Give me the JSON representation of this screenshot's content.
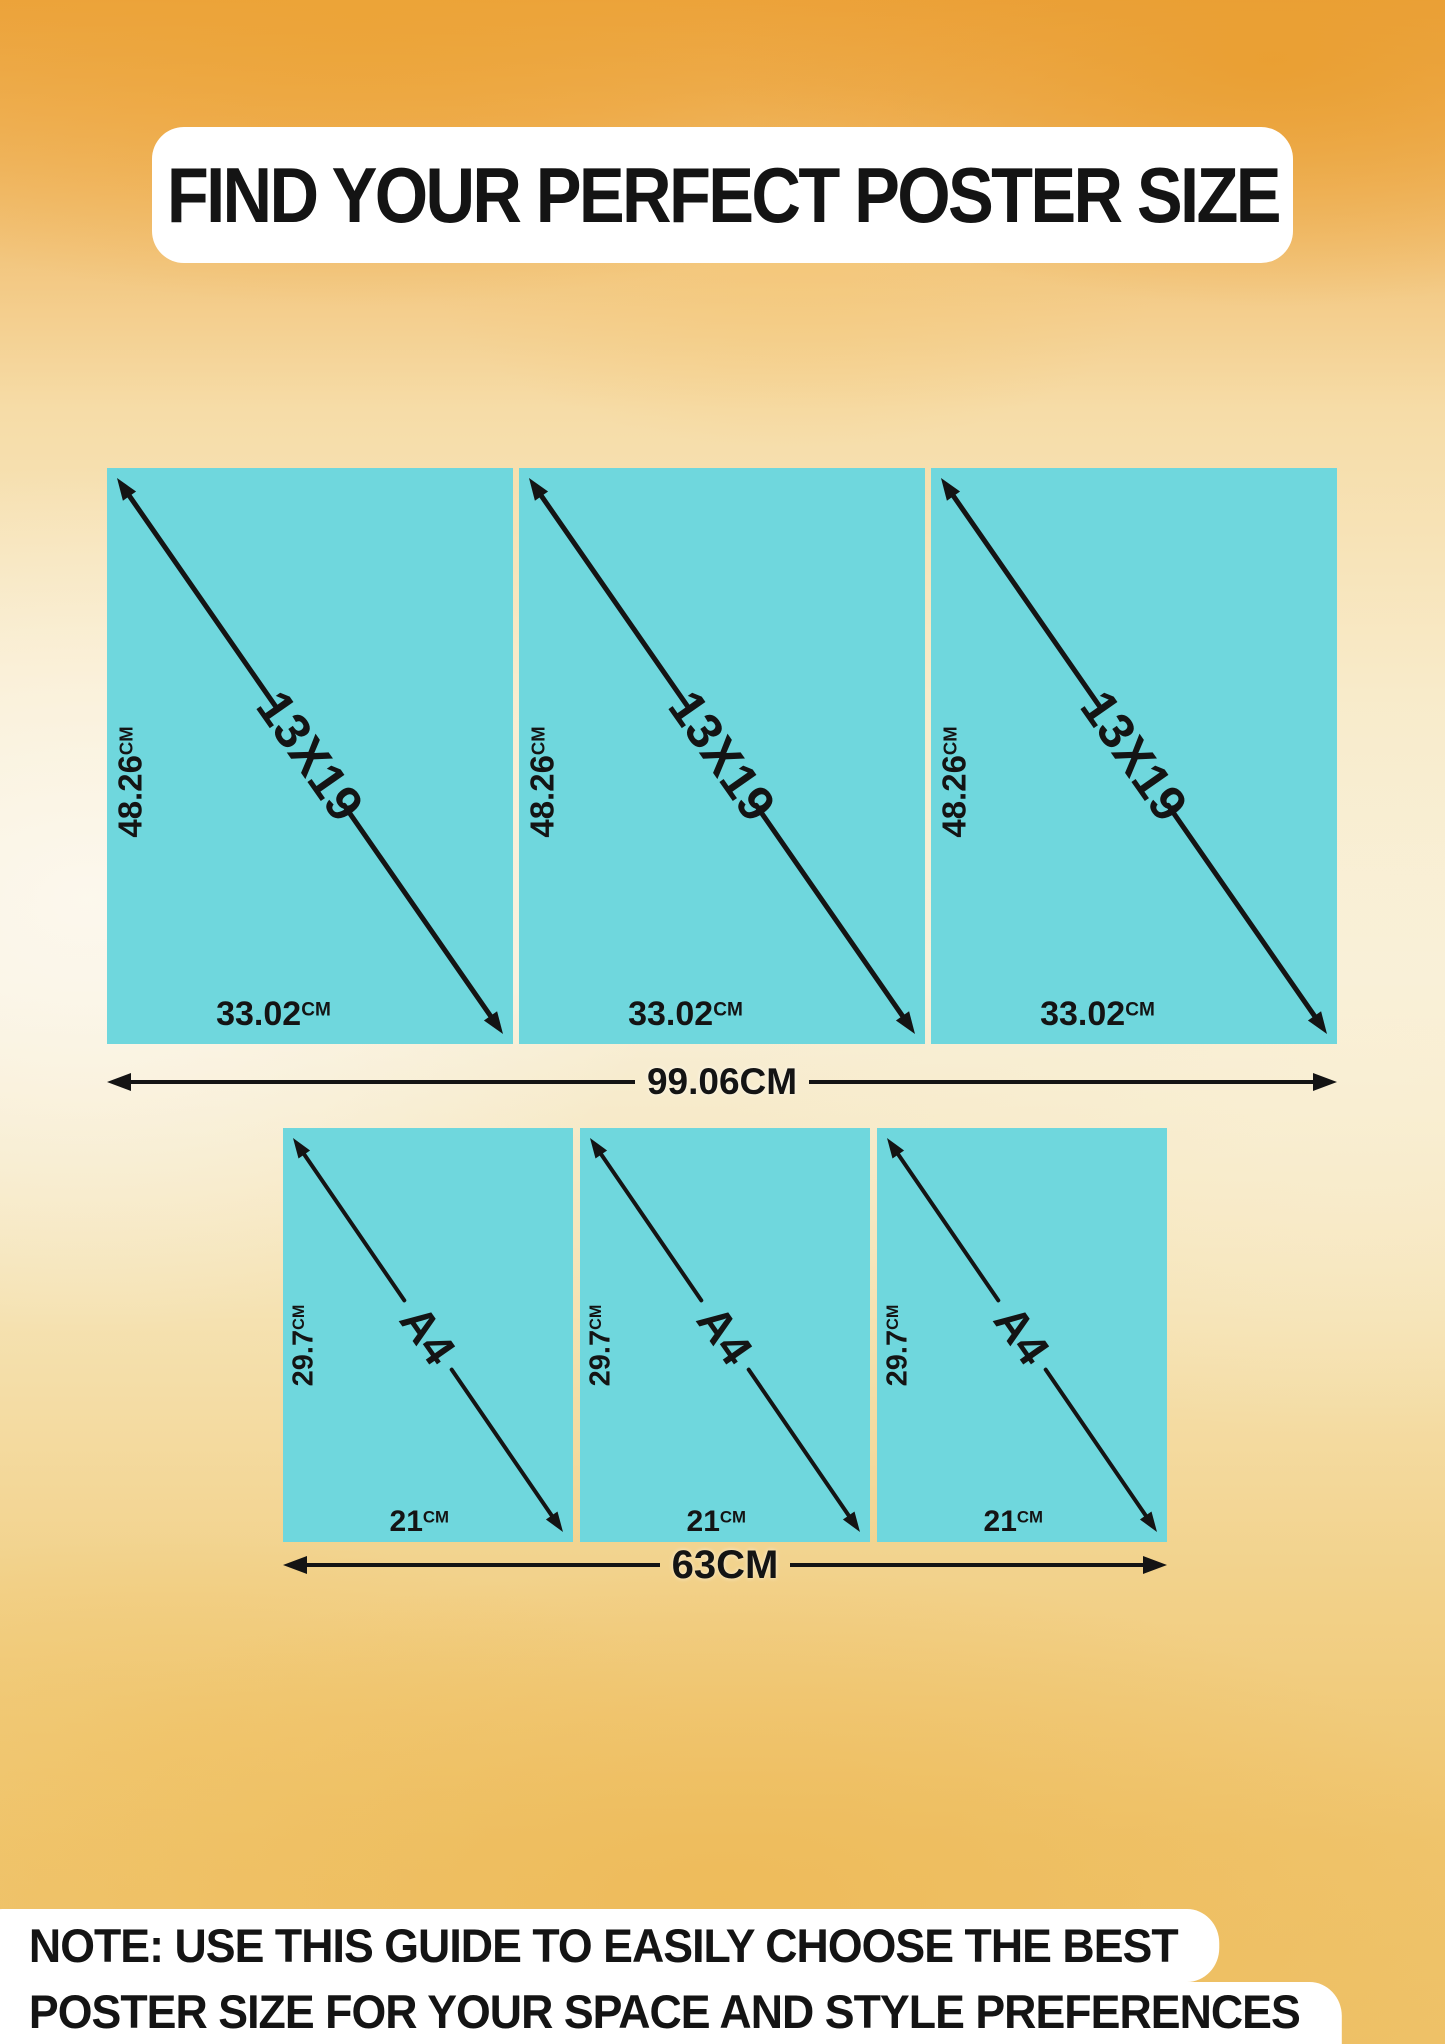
{
  "page": {
    "title": "FIND YOUR PERFECT POSTER SIZE"
  },
  "note": {
    "line1": "NOTE: USE THIS GUIDE TO EASILY CHOOSE THE BEST",
    "line2": "POSTER SIZE FOR YOUR SPACE AND STYLE PREFERENCES"
  },
  "colors": {
    "poster": "#6FD7DD",
    "ink": "#141414",
    "panel": "#FFFFFF",
    "bg_orange": "#ECA23C",
    "bg_cream": "#F8EFDA",
    "bg_gold": "#EEC167"
  },
  "rows": [
    {
      "id": "13x19",
      "diagonal_label": "13X19",
      "height_value": "48.26",
      "height_unit": "CM",
      "width_value": "33.02",
      "width_unit": "CM",
      "total_width_label": "99.06CM",
      "poster_count": 3
    },
    {
      "id": "a4",
      "diagonal_label": "A4",
      "height_value": "29.7",
      "height_unit": "CM",
      "width_value": "21",
      "width_unit": "CM",
      "total_width_label": "63CM",
      "poster_count": 3
    }
  ]
}
